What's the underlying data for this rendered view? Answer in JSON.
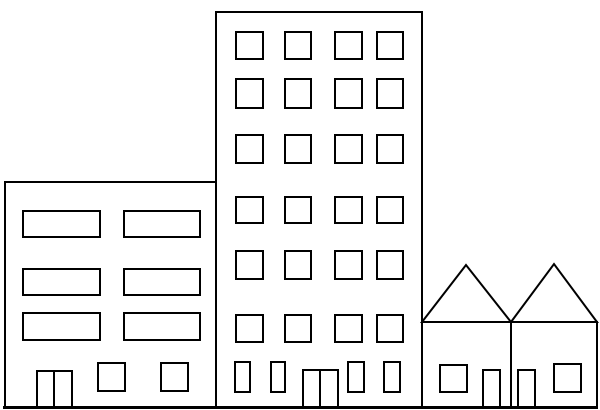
{
  "illustration": {
    "description": "Black-and-white line drawing of a city block: a wide three-storey apartment building on the left, a tall six-storey tower in the middle, and two attached gable-roof houses on the right, all standing on a ground line.",
    "canvas": {
      "width": 600,
      "height": 410,
      "background": "#ffffff"
    },
    "style": {
      "line_color": "#000000",
      "line_width": 2,
      "ground_line_width": 3,
      "fill": "#ffffff"
    },
    "ground": {
      "x1": 3,
      "y": 407.5,
      "x2": 598
    },
    "buildings": [
      {
        "name": "left-apartment-building",
        "body": [
          5,
          182,
          211,
          226
        ],
        "windows": [
          [
            23,
            211,
            77,
            26
          ],
          [
            124,
            211,
            76,
            26
          ],
          [
            23,
            269,
            77,
            26
          ],
          [
            124,
            269,
            76,
            26
          ],
          [
            23,
            313,
            77,
            27
          ],
          [
            124,
            313,
            76,
            27
          ],
          [
            98,
            363,
            27,
            28
          ],
          [
            161,
            363,
            27,
            28
          ]
        ],
        "doors": [
          {
            "rect": [
              37,
              371,
              35,
              37
            ],
            "divider_x": 54
          }
        ]
      },
      {
        "name": "center-tower-building",
        "body": [
          216,
          12,
          206,
          396
        ],
        "windows": [
          [
            236,
            32,
            27,
            27
          ],
          [
            285,
            32,
            26,
            27
          ],
          [
            335,
            32,
            27,
            27
          ],
          [
            377,
            32,
            26,
            27
          ],
          [
            236,
            79,
            27,
            29
          ],
          [
            285,
            79,
            26,
            29
          ],
          [
            335,
            79,
            27,
            29
          ],
          [
            377,
            79,
            26,
            29
          ],
          [
            236,
            135,
            27,
            28
          ],
          [
            285,
            135,
            26,
            28
          ],
          [
            335,
            135,
            27,
            28
          ],
          [
            377,
            135,
            26,
            28
          ],
          [
            236,
            197,
            27,
            26
          ],
          [
            285,
            197,
            26,
            26
          ],
          [
            335,
            197,
            27,
            26
          ],
          [
            377,
            197,
            26,
            26
          ],
          [
            236,
            251,
            27,
            28
          ],
          [
            285,
            251,
            26,
            28
          ],
          [
            335,
            251,
            27,
            28
          ],
          [
            377,
            251,
            26,
            28
          ],
          [
            236,
            315,
            27,
            27
          ],
          [
            285,
            315,
            26,
            27
          ],
          [
            335,
            315,
            27,
            27
          ],
          [
            377,
            315,
            26,
            27
          ],
          [
            235,
            362,
            15,
            30
          ],
          [
            271,
            362,
            14,
            30
          ],
          [
            348,
            362,
            16,
            30
          ],
          [
            384,
            362,
            16,
            30
          ]
        ],
        "doors": [
          {
            "rect": [
              303,
              370,
              35,
              38
            ],
            "divider_x": 320
          }
        ]
      },
      {
        "name": "right-house-1",
        "body": [
          422,
          322,
          89,
          86
        ],
        "roof": [
          [
            422,
            322
          ],
          [
            466,
            265
          ],
          [
            511,
            322
          ]
        ],
        "windows": [
          [
            440,
            365,
            27,
            27
          ]
        ],
        "doors": [
          {
            "rect": [
              483,
              370,
              17,
              38
            ]
          }
        ]
      },
      {
        "name": "right-house-2",
        "body": [
          511,
          322,
          86,
          86
        ],
        "roof": [
          [
            511,
            322
          ],
          [
            554,
            264
          ],
          [
            597,
            322
          ]
        ],
        "windows": [
          [
            554,
            364,
            27,
            28
          ]
        ],
        "doors": [
          {
            "rect": [
              518,
              370,
              17,
              38
            ]
          }
        ]
      }
    ]
  }
}
